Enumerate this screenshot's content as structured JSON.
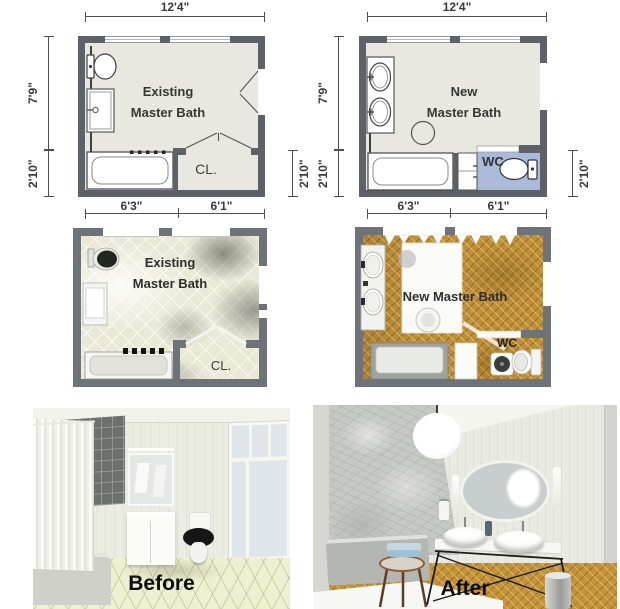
{
  "plans_2d": {
    "existing": {
      "title_line1": "Existing",
      "title_line2": "Master Bath",
      "closet_label": "CL.",
      "dim_width": "12'4\"",
      "dim_height_upper": "7'9\"",
      "dim_height_lower": "2'10\"",
      "dim_right_lower": "2'10\"",
      "dim_bottom_left": "6'3\"",
      "dim_bottom_right": "6'1\""
    },
    "new": {
      "title_line1": "New",
      "title_line2": "Master Bath",
      "wc_label": "WC",
      "dim_width": "12'4\"",
      "dim_height_upper": "7'9\"",
      "dim_height_lower": "2'10\"",
      "dim_right_lower": "2'10\"",
      "dim_bottom_left": "6'3\"",
      "dim_bottom_right": "6'1\""
    }
  },
  "plans_3d": {
    "existing": {
      "title_line1": "Existing",
      "title_line2": "Master Bath",
      "closet_label": "CL."
    },
    "new": {
      "title": "New Master Bath",
      "wc_label": "WC"
    }
  },
  "renders": {
    "before_label": "Before",
    "after_label": "After"
  },
  "colors": {
    "wall_2d": "#5d6268",
    "wall_3d": "#6e737a",
    "floor_2d": "#e8e8e0",
    "wc_floor_blue": "#a9bada",
    "tile_floor_3d": "#eae9d6",
    "wood_floor": "#c09038",
    "dim_text": "#3a3a3a",
    "label_text": "#0c0c0c"
  }
}
